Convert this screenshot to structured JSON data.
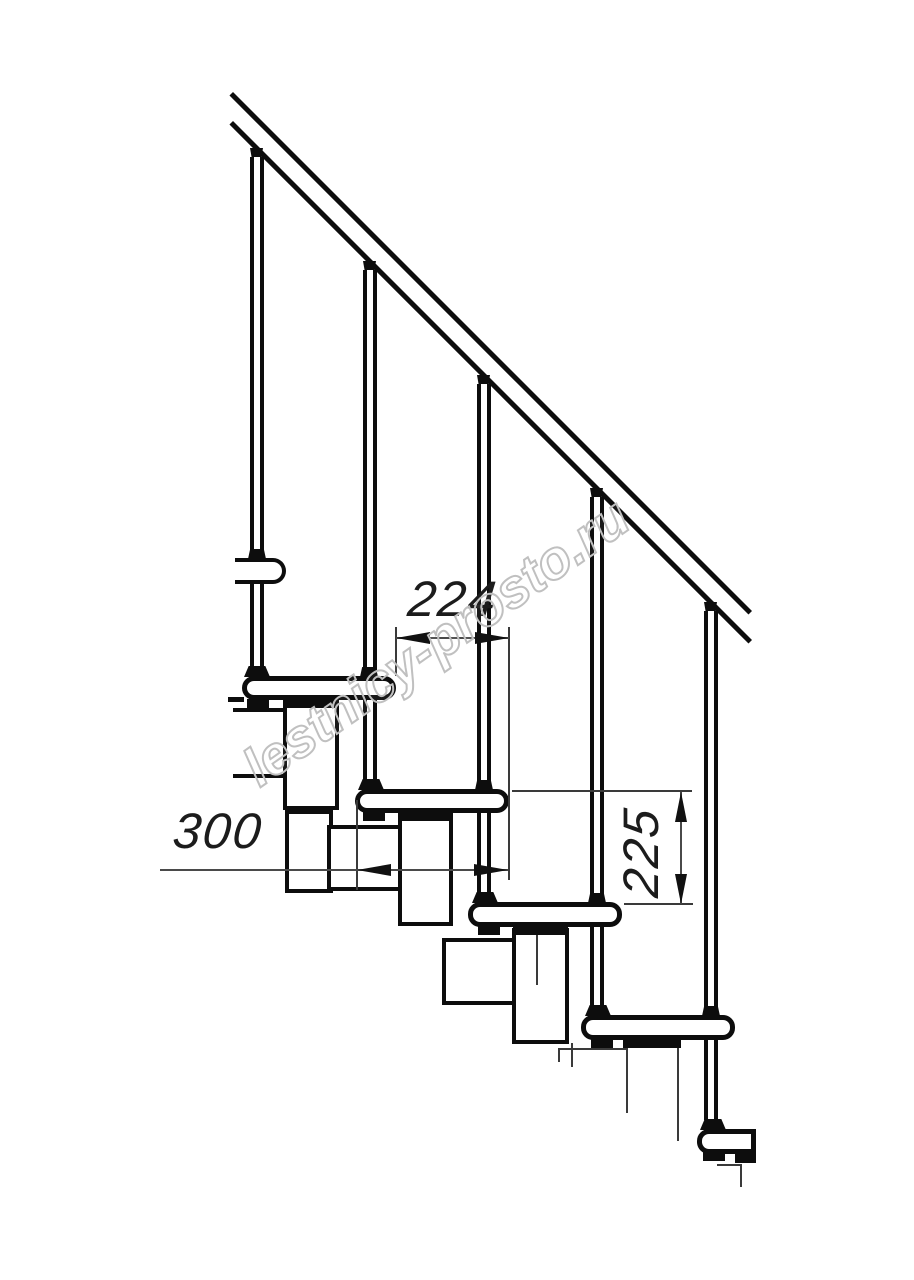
{
  "drawing": {
    "title": "modular staircase side elevation drawing",
    "dimensions": {
      "going": {
        "value": "224",
        "orientation": "horizontal",
        "measures": "horizontal offset between consecutive tread noses"
      },
      "tread_depth": {
        "value": "300",
        "orientation": "horizontal",
        "measures": "tread depth"
      },
      "rise": {
        "value": "225",
        "orientation": "vertical",
        "measures": "riser height between treads"
      }
    },
    "watermark": {
      "text": "lestnicy-prosto.ru"
    },
    "parts": {
      "handrail": "inclined double-line handrail at 45 degrees",
      "balusters": 5,
      "treads": 5,
      "support_modules": "central modular stringer blocks under each tread"
    },
    "colors": {
      "background": "#ffffff",
      "line": "#0d0d0d",
      "dimension_line": "#4a4a4a",
      "dimension_text": "#1c1c1c",
      "watermark_stroke": "#c0c0c0"
    }
  }
}
